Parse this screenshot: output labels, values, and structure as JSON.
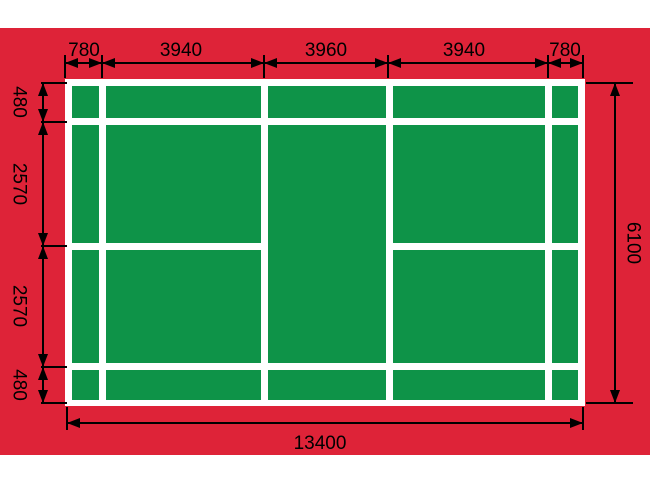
{
  "diagram": {
    "subject": "badminton-court-dimension-diagram",
    "units_implied": "mm"
  },
  "colors": {
    "page_background": "#ffffff",
    "mat_red": "#de2338",
    "court_green": "#0e9348",
    "court_lines_white": "#ffffff",
    "dimension_ink": "#000000"
  },
  "dimensions": {
    "top_segments": [
      "780",
      "3940",
      "3960",
      "3940",
      "780"
    ],
    "left_segments": [
      "480",
      "2570",
      "2570",
      "480"
    ],
    "right_total": "6100",
    "bottom_total": "13400"
  }
}
